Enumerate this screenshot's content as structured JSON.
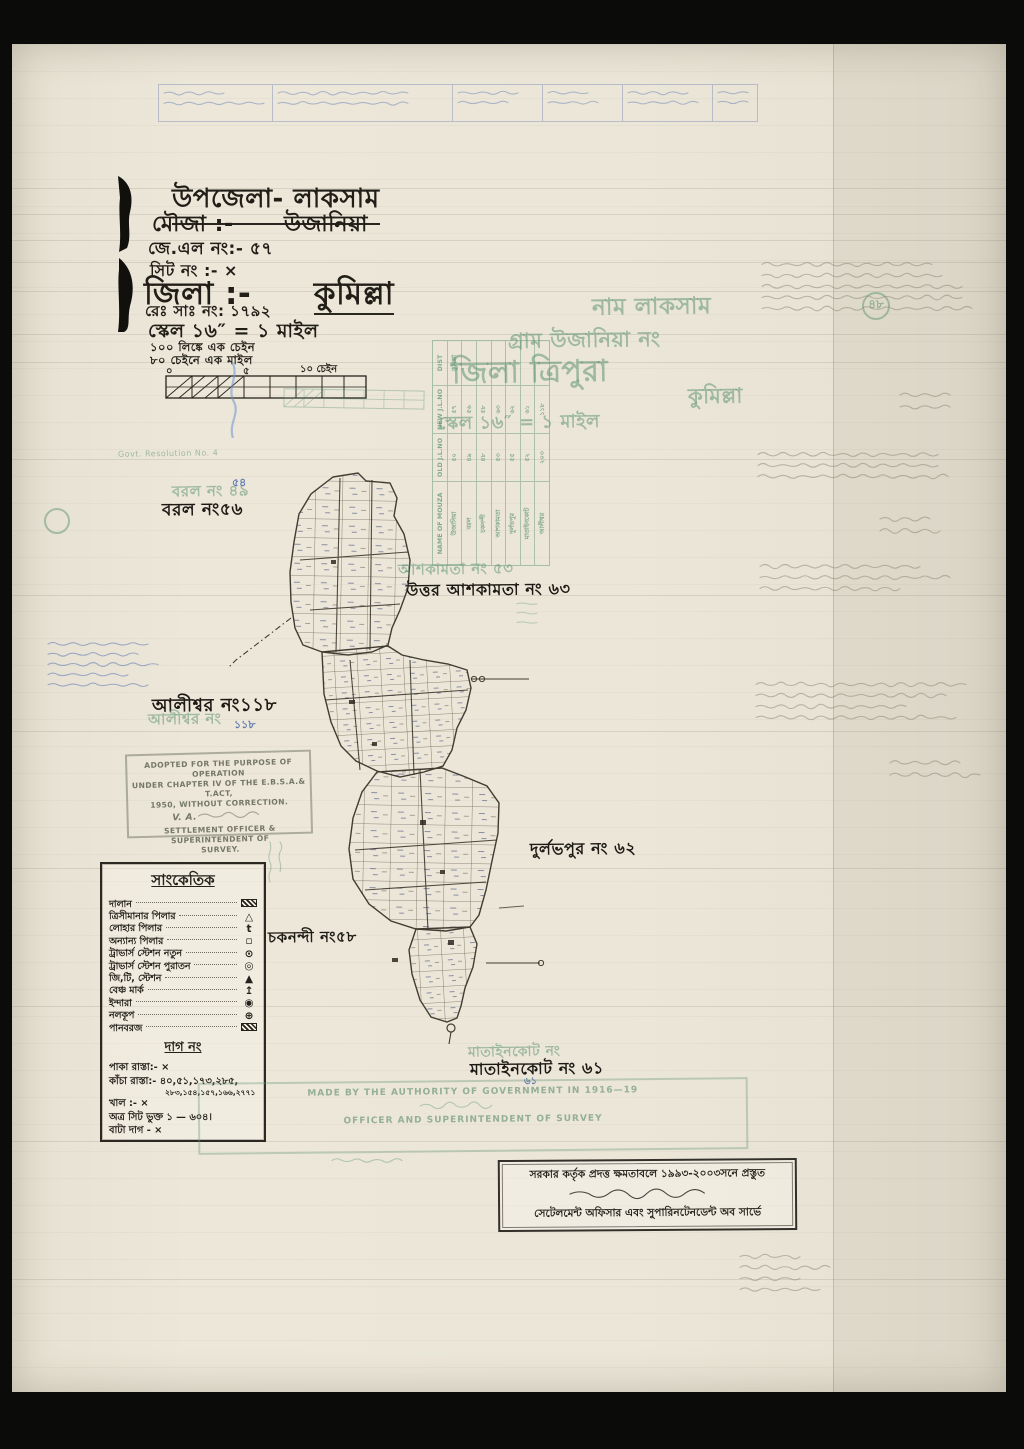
{
  "header": {
    "upazila": "উপজেলা- লাকসাম",
    "mouza_label": "মৌজা :-",
    "mouza_value": "উজানিয়া",
    "jl_no": "জে.এল নং:- ৫৭",
    "sheet_no": "সিট নং :- ×",
    "zila_label": "জিলা :-",
    "zila_value": "কুমিল্লা",
    "reg_no": "রেঃ সাঃ নং: ১৭৯২",
    "scale": "স্কেল ১৬″ = ১ মাইল",
    "scale_note1": "১০০ লিঙ্কে এক চেইন",
    "scale_note2": "৮০ চেইনে এক মাইল"
  },
  "scalebar": {
    "zero": "০",
    "five": "৫",
    "ten": "১০ চেইন"
  },
  "ghost_header": {
    "line1": "নাম  লাকসাম",
    "line2": "গ্রাম  উজানিয়া  নং",
    "circled": "৪৮",
    "line3": "জিলা  ত্রিপুরা",
    "line4": "কুমিল্লা",
    "line5": "স্কেল ১৬″ = ১ মাইল",
    "resolution": "Govt. Resolution No. 4"
  },
  "ghost_table": {
    "headers": {
      "name": "NAME OF MOUZA",
      "old": "OLD J.L.NO",
      "new": "NEW J.L.NO",
      "dist": "DIST"
    },
    "rows": [
      {
        "name": "উজানিয়া",
        "old": "৫০",
        "new": "৫৭",
        "dist": "কুমিল্লা"
      },
      {
        "name": "বরল",
        "old": "৪৯",
        "new": "৫৬",
        "dist": ""
      },
      {
        "name": "চকনন্দী",
        "old": "৪৮",
        "new": "৫৮",
        "dist": ""
      },
      {
        "name": "আশকামতা",
        "old": "৫৩",
        "new": "৬৩",
        "dist": ""
      },
      {
        "name": "দুর্লভপুর",
        "old": "৫৫",
        "new": "৬২",
        "dist": ""
      },
      {
        "name": "মাতাইনকোট",
        "old": "৫২",
        "new": "৬১",
        "dist": ""
      },
      {
        "name": "আলীশ্বর",
        "old": "২০৩",
        "new": "১১৮",
        "dist": ""
      }
    ]
  },
  "map_labels": {
    "barol": "বরল নং৫৬",
    "barol_ghost": "বরল নং ৪৯",
    "barol_blue": "৫৪",
    "ashkamta": "উত্তর আশকামতা নং ৬৩",
    "ashkamta_ghost": "আশকামতা নং ৫৩",
    "alishwar": "আলীশ্বর নং১১৮",
    "alishwar_ghost": "আলীশ্বর নং",
    "alishwar_blue": "১১৮",
    "durlabhpur": "দুর্লভপুর নং ৬২",
    "chakanandi": "চকনন্দী নং৫৮",
    "matainkot": "মাতাইনকোট নং ৬১",
    "matainkot_ghost": "মাতাইনকোট নং",
    "matainkot_blue": "৬১"
  },
  "legend": {
    "title": "সাংকেতিক",
    "items": [
      {
        "label": "দালান",
        "sym": ""
      },
      {
        "label": "ত্রিসীমানার পিলার",
        "sym": "△"
      },
      {
        "label": "লোহার পিলার",
        "sym": "t"
      },
      {
        "label": "অন্যান্য পিলার",
        "sym": "▫"
      },
      {
        "label": "ট্রাভার্স স্টেশন নতুন",
        "sym": "⊙"
      },
      {
        "label": "ট্রাভার্স স্টেশন পুরাতন",
        "sym": "◎"
      },
      {
        "label": "জি,টি, স্টেশন",
        "sym": "▲"
      },
      {
        "label": "বেঞ্চ মার্ক",
        "sym": "↥"
      },
      {
        "label": "ইন্দারা",
        "sym": "◉"
      },
      {
        "label": "নলকূপ",
        "sym": "⊕"
      },
      {
        "label": "পানবরজ",
        "sym": ""
      }
    ],
    "dag_title": "দাগ নং",
    "dag_lines": [
      "পাকা রাস্তা:- ×",
      "কাঁচা রাস্তা:- ৪০,৫১,১৭৩,২৮৫,",
      "২৮৩,১৫৪,১৫৭,১৬৬,২৭৭১",
      "খাল        :- ×",
      "অত্র সিট ভুক্ত ১ — ৬০৪।",
      "বাটা দাগ  - ×"
    ]
  },
  "stamps": {
    "adopted": {
      "l1": "ADOPTED FOR THE PURPOSE OF OPERATION",
      "l2": "UNDER CHAPTER IV OF THE E.B.S.A.& T.ACT,",
      "l3": "1950, WITHOUT CORRECTION.",
      "sig": "V. A.",
      "l4": "SETTLEMENT OFFICER & SUPERINTENDENT OF",
      "l5": "SURVEY."
    },
    "made": {
      "l1": "MADE BY THE AUTHORITY OF GOVERNMENT IN 1916—19",
      "l2": "OFFICER AND SUPERINTENDENT OF SURVEY"
    },
    "bottom": {
      "l1": "সরকার কর্তৃক প্রদত্ত ক্ষমতাবলে ১৯৯৩-২০০৩সনে প্রস্তুত",
      "l2": "সেটেলমেন্ট অফিসার এবং সুপারিনটেনডেন্ট অব সার্ভে"
    }
  }
}
